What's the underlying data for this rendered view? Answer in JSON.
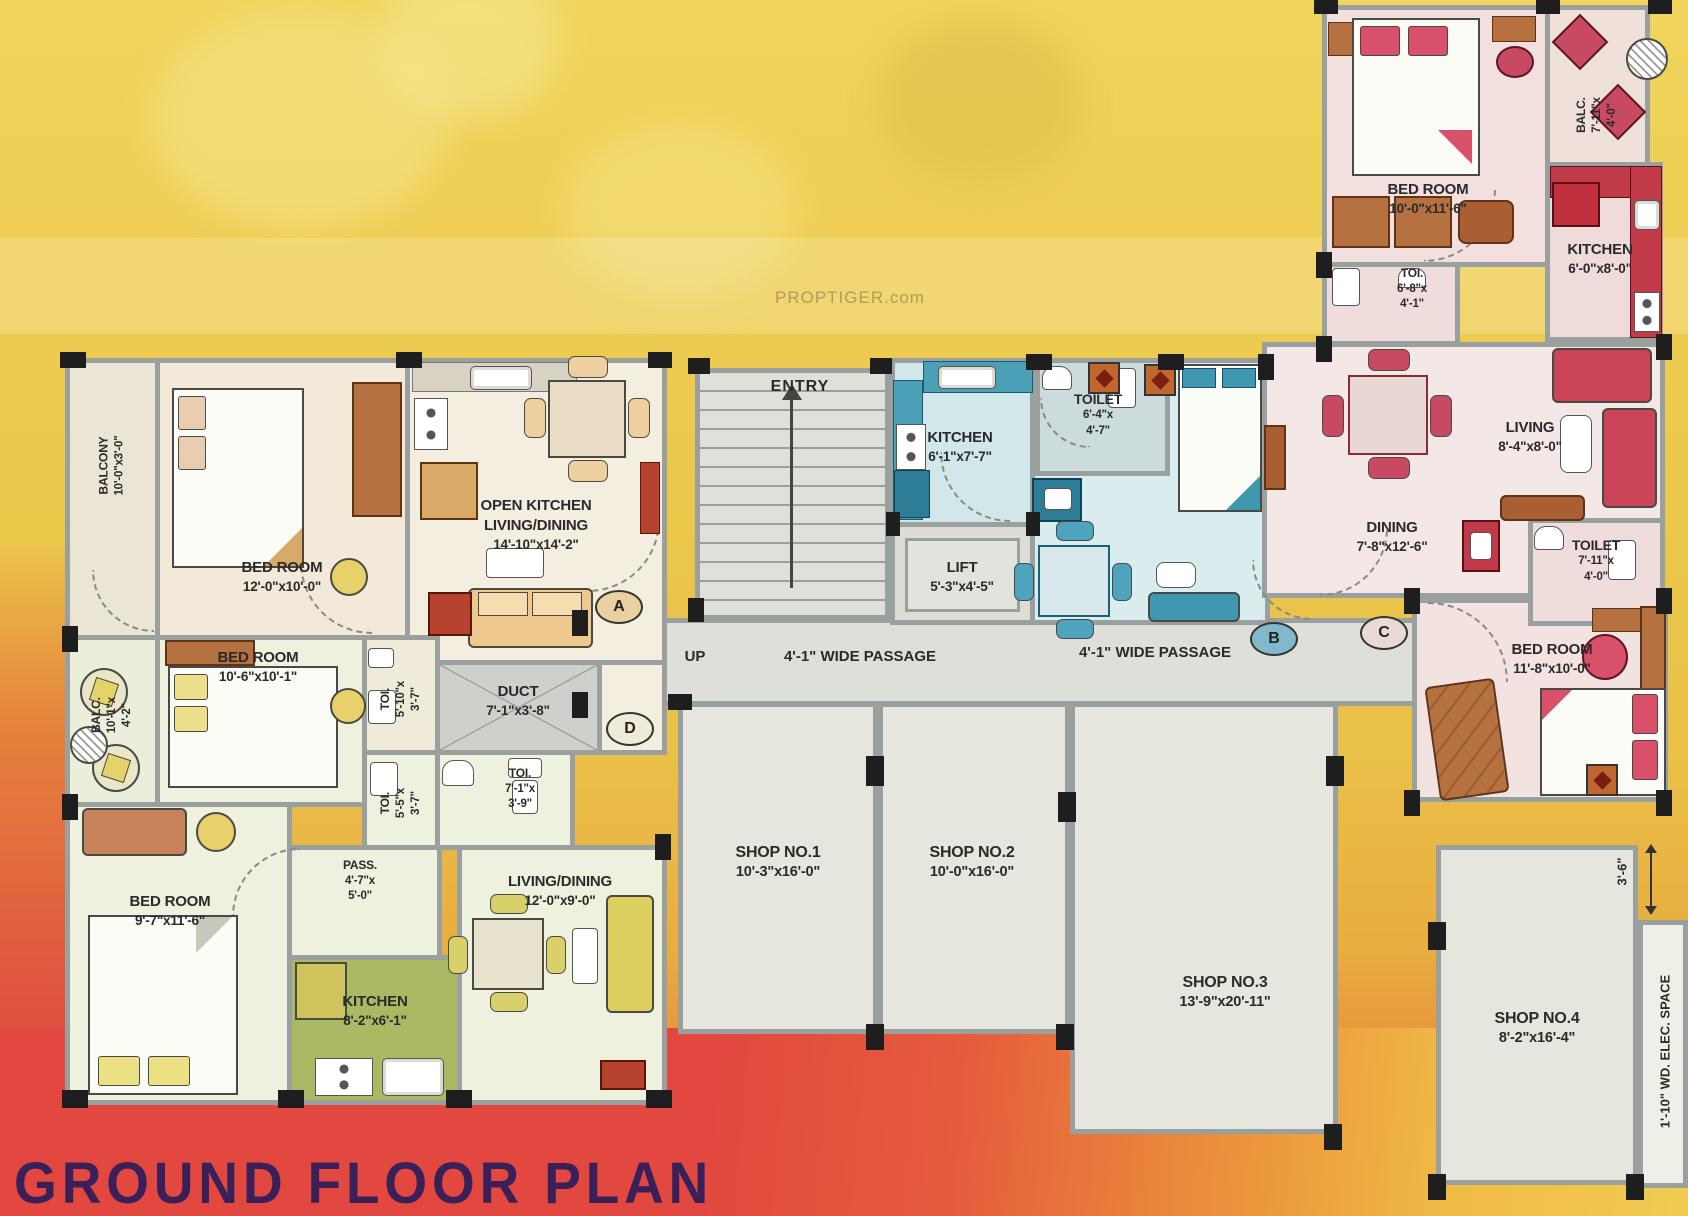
{
  "title": "GROUND FLOOR PLAN",
  "watermark": "PROPTIGER.com",
  "annotations": {
    "entry": "ENTRY",
    "up": "UP",
    "passage_left": "4'-1\" WIDE PASSAGE",
    "passage_right": "4'-1\" WIDE PASSAGE",
    "dim_gap": "3'-6\"",
    "elec_space": "1'-10\" WD. ELEC. SPACE"
  },
  "markers": {
    "a": "A",
    "b": "B",
    "c": "C",
    "d": "D"
  },
  "rooms": {
    "balcony_tl": {
      "name": "BALCONY",
      "dims": "10'-0\"x3'-0\""
    },
    "bedroom_tl": {
      "name": "BED ROOM",
      "dims": "12'-0\"x10'-0\""
    },
    "open_kitchen": {
      "name": "OPEN KITCHEN",
      "name2": "LIVING/DINING",
      "dims": "14'-10\"x14'-2\""
    },
    "balc_ml": {
      "name": "BALC.",
      "dims": "10'-1\"x",
      "dims2": "4'-2\""
    },
    "bedroom_ml": {
      "name": "BED ROOM",
      "dims": "10'-6\"x10'-1\""
    },
    "toi_top": {
      "name": "TOI.",
      "dims": "5'-10\"x",
      "dims2": "3'-7\""
    },
    "duct": {
      "name": "DUCT",
      "dims": "7'-1\"x3'-8\""
    },
    "toi_mid": {
      "name": "TOI.",
      "dims": "5'-5\"x",
      "dims2": "3'-7\""
    },
    "toi_bottom": {
      "name": "TOI.",
      "dims": "7'-1\"x",
      "dims2": "3'-9\""
    },
    "bedroom_bl": {
      "name": "BED ROOM",
      "dims": "9'-7\"x11'-6\""
    },
    "pass": {
      "name": "PASS.",
      "dims": "4'-7\"x",
      "dims2": "5'-0\""
    },
    "kitchen_left": {
      "name": "KITCHEN",
      "dims": "8'-2\"x6'-1\""
    },
    "living_dining_left": {
      "name": "LIVING/DINING",
      "dims": "12'-0\"x9'-0\""
    },
    "kitchen_mid": {
      "name": "KITCHEN",
      "dims": "6'-1\"x7'-7\""
    },
    "toilet_mid": {
      "name": "TOILET",
      "dims": "6'-4\"x",
      "dims2": "4'-7\""
    },
    "lift": {
      "name": "LIFT",
      "dims": "5'-3\"x4'-5\""
    },
    "bedroom_tr": {
      "name": "BED ROOM",
      "dims": "10'-0\"x11'-6\""
    },
    "balc_tr": {
      "name": "BALC.",
      "dims": "7'-11\"x",
      "dims2": "4'-0\""
    },
    "kitchen_right": {
      "name": "KITCHEN",
      "dims": "6'-0\"x8'-0\""
    },
    "toi_right": {
      "name": "TOI.",
      "dims": "6'-8\"x",
      "dims2": "4'-1\""
    },
    "living_right": {
      "name": "LIVING",
      "dims": "8'-4\"x8'-0\""
    },
    "dining_right": {
      "name": "DINING",
      "dims": "7'-8\"x12'-6\""
    },
    "toilet_right": {
      "name": "TOILET",
      "dims": "7'-11\"x",
      "dims2": "4'-0\""
    },
    "bedroom_br": {
      "name": "BED ROOM",
      "dims": "11'-8\"x10'-0\""
    },
    "shop1": {
      "name": "SHOP NO.1",
      "dims": "10'-3\"x16'-0\""
    },
    "shop2": {
      "name": "SHOP NO.2",
      "dims": "10'-0\"x16'-0\""
    },
    "shop3": {
      "name": "SHOP NO.3",
      "dims": "13'-9\"x20'-11\""
    },
    "shop4": {
      "name": "SHOP NO.4",
      "dims": "8'-2\"x16'-4\""
    }
  },
  "colors": {
    "background_yellow": "#ecc94c",
    "band_red": "#e2483f",
    "band_orange": "#eda23c",
    "title_color": "#3a2059",
    "wall": "#9aa09d",
    "column": "#1e1e1e",
    "unit_left_cream": "#f2e9d9",
    "unit_left_green": "#edf1de",
    "kitchen_olive": "#aaba64",
    "unit_blue": "#d9ecee",
    "teal": "#4b9fb6",
    "unit_pink": "#f2e2e0",
    "red_accent": "#c23b49",
    "shop_gray": "#e6e6df"
  }
}
